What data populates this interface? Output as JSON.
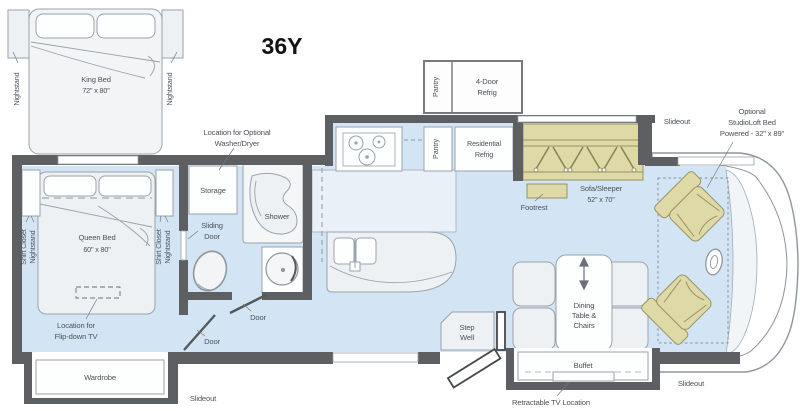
{
  "title": "36Y",
  "colors": {
    "floor": "#d3e5f4",
    "wall": "#5d5f62",
    "furniture": "#eef1f4",
    "accent_tan": "#ded9a6"
  },
  "king_option": {
    "bed": "King Bed",
    "size": "72\" x 80\"",
    "nightstand": "Nightstand"
  },
  "bedroom": {
    "bed": "Queen Bed",
    "size": "60\" x 80\"",
    "shirt_closet": "Shirt Closet",
    "nightstand": "Nightstand",
    "tv_line1": "Location for",
    "tv_line2": "Flip-down TV",
    "wardrobe": "Wardrobe"
  },
  "bath": {
    "storage": "Storage",
    "sliding_line1": "Sliding",
    "sliding_line2": "Door",
    "shower": "Shower",
    "door": "Door",
    "washer_line1": "Location for Optional",
    "washer_line2": "Washer/Dryer"
  },
  "kitchen": {
    "pantry": "Pantry",
    "fourdoor_line1": "4-Door",
    "fourdoor_line2": "Refrig",
    "res_line1": "Residential",
    "res_line2": "Refrig"
  },
  "living": {
    "sofa_line1": "Sofa/Sleeper",
    "sofa_line2": "52\" x 70\"",
    "footrest": "Footrest",
    "dining_line1": "Dining",
    "dining_line2": "Table &",
    "dining_line3": "Chairs",
    "buffet": "Buffet",
    "tv_note": "Retractable TV Location",
    "step_line1": "Step",
    "step_line2": "Well"
  },
  "cab": {
    "loft_line1": "Optional",
    "loft_line2": "StudioLoft Bed",
    "loft_line3": "Powered - 32\" x 89\""
  },
  "slideout": "Slideout"
}
